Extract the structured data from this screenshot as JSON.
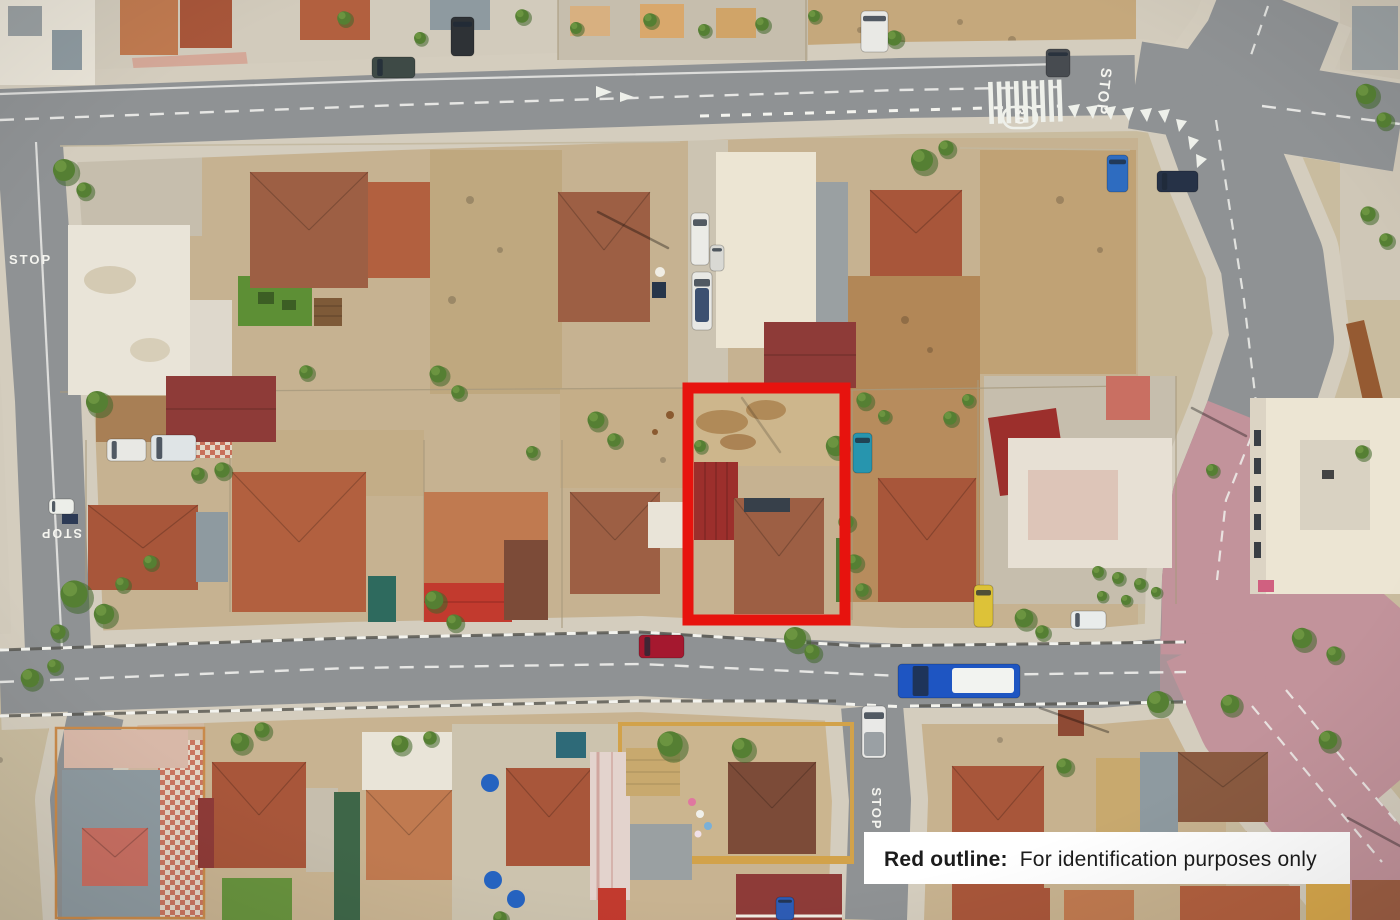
{
  "road_markings": {
    "stop_top_right": "STOP",
    "stop_left_upper": "STOP",
    "stop_left_lower": "STOP",
    "stop_bottom_street": "STOP",
    "speed_limit": "30"
  },
  "legend": {
    "bold": "Red outline:",
    "text": "For identification purposes only"
  },
  "colors": {
    "red_outline": "#e7130e",
    "label_bg": "#ffffff",
    "label_text": "#1c1c1c",
    "road_gray": "#8f9294",
    "road_pink": "#c2939b",
    "marking_white": "#f2f2ee",
    "bus_blue": "#1e55c2"
  },
  "trees": [
    [
      64,
      170,
      13
    ],
    [
      84,
      190,
      9
    ],
    [
      97,
      402,
      13
    ],
    [
      74,
      594,
      16
    ],
    [
      104,
      614,
      12
    ],
    [
      58,
      632,
      9
    ],
    [
      198,
      474,
      8
    ],
    [
      222,
      470,
      9
    ],
    [
      306,
      372,
      8
    ],
    [
      438,
      374,
      10
    ],
    [
      458,
      392,
      8
    ],
    [
      434,
      600,
      11
    ],
    [
      454,
      622,
      9
    ],
    [
      532,
      452,
      7
    ],
    [
      596,
      420,
      10
    ],
    [
      614,
      440,
      8
    ],
    [
      700,
      446,
      7
    ],
    [
      795,
      638,
      13
    ],
    [
      812,
      652,
      9
    ],
    [
      836,
      446,
      12
    ],
    [
      846,
      522,
      9
    ],
    [
      864,
      400,
      9
    ],
    [
      884,
      416,
      7
    ],
    [
      854,
      562,
      9
    ],
    [
      862,
      590,
      8
    ],
    [
      922,
      160,
      13
    ],
    [
      946,
      148,
      9
    ],
    [
      1024,
      618,
      11
    ],
    [
      1042,
      632,
      8
    ],
    [
      344,
      18,
      8
    ],
    [
      420,
      38,
      7
    ],
    [
      522,
      16,
      8
    ],
    [
      576,
      28,
      7
    ],
    [
      650,
      20,
      8
    ],
    [
      704,
      30,
      7
    ],
    [
      762,
      24,
      8
    ],
    [
      814,
      16,
      7
    ],
    [
      894,
      38,
      9
    ],
    [
      1366,
      94,
      12
    ],
    [
      1384,
      120,
      9
    ],
    [
      1368,
      214,
      9
    ],
    [
      1386,
      240,
      8
    ],
    [
      1362,
      452,
      8
    ],
    [
      1302,
      638,
      12
    ],
    [
      1334,
      654,
      9
    ],
    [
      1212,
      470,
      7
    ],
    [
      240,
      742,
      11
    ],
    [
      262,
      730,
      9
    ],
    [
      400,
      744,
      10
    ],
    [
      430,
      738,
      8
    ],
    [
      670,
      744,
      15
    ],
    [
      742,
      748,
      12
    ],
    [
      1158,
      702,
      13
    ],
    [
      1230,
      704,
      11
    ],
    [
      1328,
      740,
      11
    ],
    [
      1064,
      766,
      9
    ],
    [
      500,
      918,
      8
    ],
    [
      30,
      678,
      11
    ],
    [
      54,
      666,
      8
    ],
    [
      150,
      562,
      8
    ],
    [
      122,
      584,
      8
    ],
    [
      950,
      418,
      8
    ],
    [
      968,
      400,
      7
    ],
    [
      1098,
      572,
      7
    ],
    [
      1118,
      578,
      7
    ],
    [
      1140,
      584,
      7
    ],
    [
      1156,
      592,
      6
    ],
    [
      1102,
      596,
      6
    ],
    [
      1126,
      600,
      6
    ]
  ],
  "vehicles": [
    {
      "name": "bus-blue",
      "x": 898,
      "y": 664,
      "w": 122,
      "h": 34,
      "color": "#1e55c2",
      "panel": [
        952,
        668,
        62,
        25,
        "#f2f3f0"
      ]
    },
    {
      "name": "car-crimson",
      "x": 639,
      "y": 635,
      "w": 45,
      "h": 23,
      "color": "#a5182f"
    },
    {
      "name": "pickup-white",
      "x": 862,
      "y": 706,
      "w": 24,
      "h": 52,
      "color": "#e9e9e7",
      "panel": [
        864,
        732,
        20,
        24,
        "#9aa0a4"
      ]
    },
    {
      "name": "car-yellow",
      "x": 974,
      "y": 585,
      "w": 19,
      "h": 42,
      "color": "#ddc238"
    },
    {
      "name": "car-teal",
      "x": 853,
      "y": 433,
      "w": 19,
      "h": 40,
      "color": "#2795ae"
    },
    {
      "name": "car-white-parked",
      "x": 1071,
      "y": 611,
      "w": 35,
      "h": 18,
      "color": "#e9eceb"
    },
    {
      "name": "car-white-left-road",
      "x": 49,
      "y": 499,
      "w": 25,
      "h": 15,
      "color": "#eceee9"
    },
    {
      "name": "car-white-yard-a",
      "x": 107,
      "y": 439,
      "w": 39,
      "h": 22,
      "color": "#e8e8e4"
    },
    {
      "name": "van-white-yard-b",
      "x": 151,
      "y": 435,
      "w": 45,
      "h": 26,
      "color": "#dfe4e6"
    },
    {
      "name": "van-white-driveway",
      "x": 691,
      "y": 213,
      "w": 18,
      "h": 52,
      "color": "#ebebe7"
    },
    {
      "name": "car-white-driveway",
      "x": 710,
      "y": 245,
      "w": 14,
      "h": 26,
      "color": "#d9d9d4"
    },
    {
      "name": "boat-white",
      "x": 692,
      "y": 272,
      "w": 20,
      "h": 58,
      "color": "#e8e8e4",
      "panel": [
        695,
        288,
        14,
        34,
        "#3c5070"
      ]
    },
    {
      "name": "car-blue-top",
      "x": 1107,
      "y": 155,
      "w": 21,
      "h": 37,
      "color": "#2e6cc0"
    },
    {
      "name": "car-navy-top",
      "x": 1157,
      "y": 171,
      "w": 41,
      "h": 21,
      "color": "#263247"
    },
    {
      "name": "car-dark-corner",
      "x": 1046,
      "y": 49,
      "w": 24,
      "h": 28,
      "color": "#474b50"
    },
    {
      "name": "car-darkteal-top",
      "x": 372,
      "y": 57,
      "w": 43,
      "h": 21,
      "color": "#3e4a46"
    },
    {
      "name": "suv-dark-top",
      "x": 451,
      "y": 17,
      "w": 23,
      "h": 39,
      "color": "#2e3236"
    },
    {
      "name": "van-white-top",
      "x": 861,
      "y": 11,
      "w": 27,
      "h": 41,
      "color": "#e9e9e5"
    },
    {
      "name": "car-blue-bottom-street",
      "x": 776,
      "y": 897,
      "w": 18,
      "h": 23,
      "color": "#2d5cb5"
    }
  ]
}
